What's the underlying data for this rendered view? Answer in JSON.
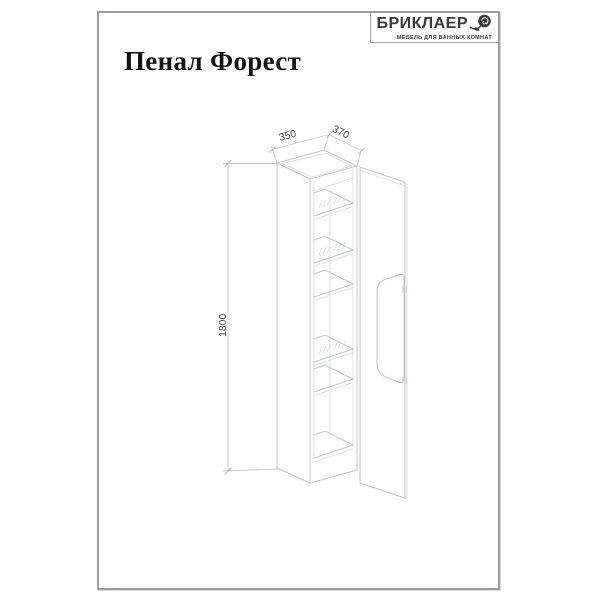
{
  "page": {
    "title": "Пенал Форест"
  },
  "logo": {
    "brand": "БРИКЛАЕР",
    "tagline": "МЕБЕЛЬ ДЛЯ ВАННЫХ КОМНАТ",
    "icon": "rose-icon"
  },
  "drawing": {
    "type": "isometric wireframe of tall cabinet with open door",
    "dim_width": "350",
    "dim_depth": "370",
    "dim_height": "1800",
    "glass_shelf_count": 3,
    "solid_shelf_count": 2
  },
  "colors": {
    "frame_border": "#9b9fa3",
    "drawing_line": "#c2c6ca",
    "dimension_text": "#4a4a4e",
    "ink": "#3a3a3c"
  }
}
